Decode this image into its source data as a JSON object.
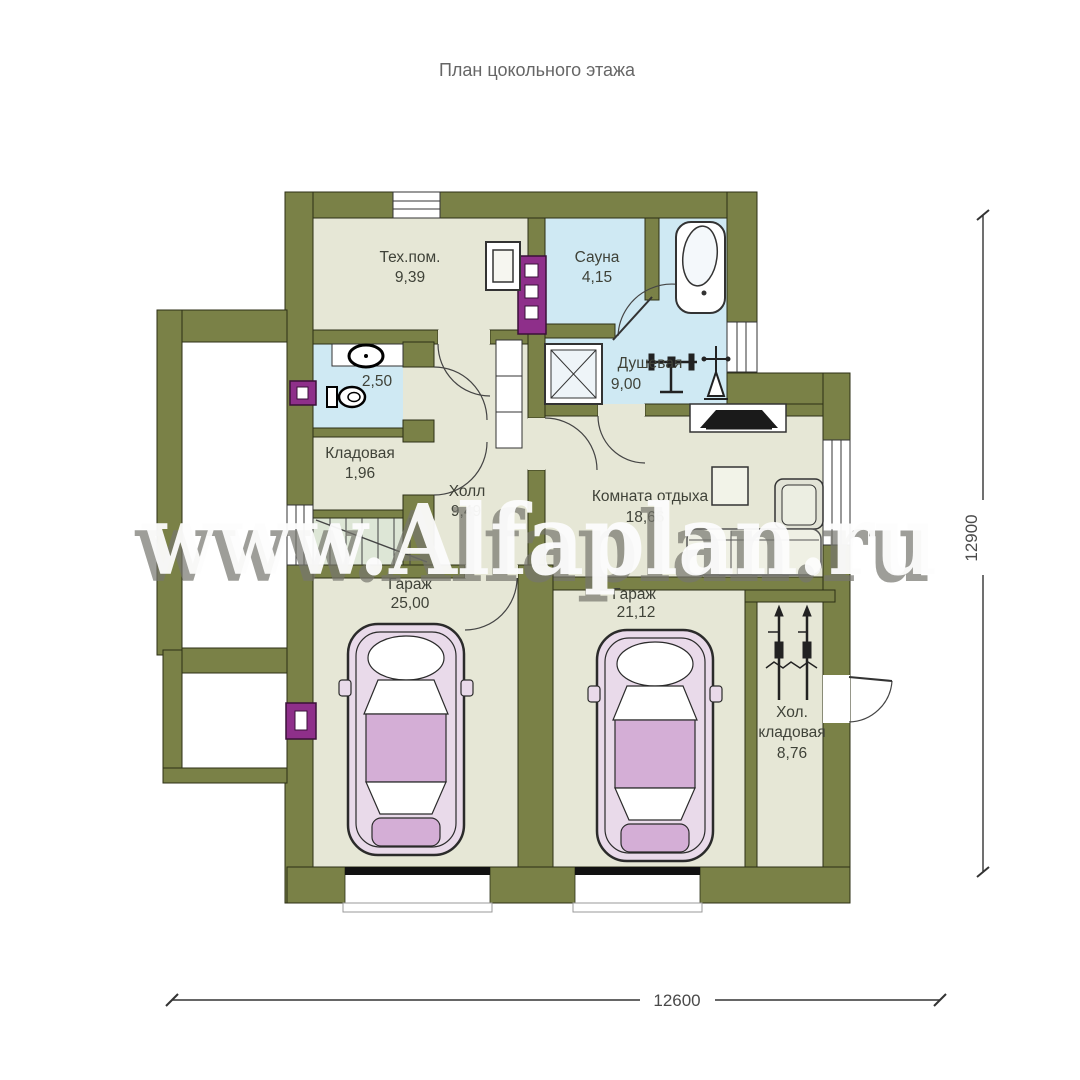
{
  "title": "План цокольного этажа",
  "watermark": "www.Alfaplan.ru",
  "dimensions": {
    "width": "12600",
    "height": "12900"
  },
  "rooms": [
    {
      "name": "Тех.пом.",
      "area": "9,39"
    },
    {
      "name": "Сауна",
      "area": "4,15"
    },
    {
      "name": "Душевая",
      "area": "9,00"
    },
    {
      "area": "2,50"
    },
    {
      "name": "Кладовая",
      "area": "1,96"
    },
    {
      "name": "Холл",
      "area": "9,49"
    },
    {
      "name": "Комната отдыха",
      "area": "18,66"
    },
    {
      "name": "Гараж",
      "area": "25,00"
    },
    {
      "name": "Гараж",
      "area": "21,12"
    },
    {
      "name_line1": "Хол.",
      "name_line2": "кладовая",
      "area": "8,76"
    }
  ],
  "colors": {
    "wall": "#7a8147",
    "floor": "#e6e7d6",
    "wet_floor": "#cfe9f3",
    "stairs_floor": "#dde6d6",
    "chimney": "#8e2f8a",
    "car_accent": "#d4aed6"
  }
}
